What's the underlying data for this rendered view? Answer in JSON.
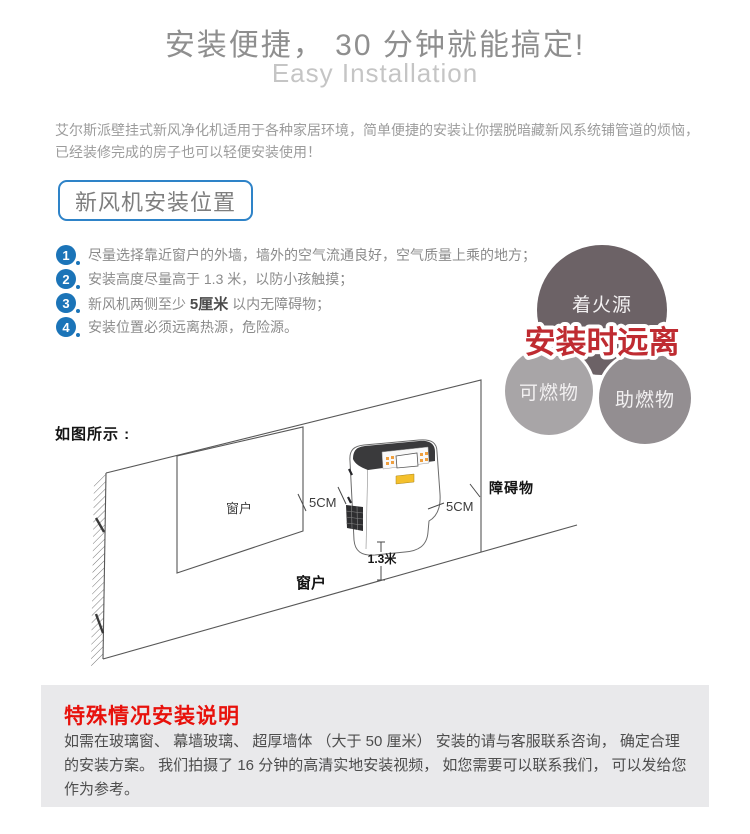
{
  "colors": {
    "blue_step": "#1b74b8",
    "blue_badge_border": "#2e83c8",
    "red_warning": "#bf2b31",
    "red_heading": "#e8120c",
    "title_gray": "#8f8f8f",
    "subtitle_gray": "#c5c5c5",
    "paragraph_gray": "#9c9c9c",
    "list_gray": "#8b8b8b",
    "badge_text_gray": "#7e7e7e",
    "panel_bg": "#e9e9eb",
    "panel_text": "#4d4d4d",
    "bubble_top_bg": "#6c6266",
    "bubble_left_bg": "#a8a5a7",
    "bubble_right_bg": "#938e91",
    "bubble_text": "#f2f0f1",
    "diagram_line": "#575757",
    "label_dark": "#141414",
    "unit_badge_yellow": "#f4c02c"
  },
  "header": {
    "title": "安装便捷， 30 分钟就能搞定!",
    "subtitle": "Easy Installation",
    "intro_line1": "艾尔斯派壁挂式新风净化机适用于各种家居环境，简单便捷的安装让你摆脱暗藏新风系统铺管道的烦恼，",
    "intro_line2": "已经装修完成的房子也可以轻便安装使用！"
  },
  "section": {
    "badge_label": "新风机安装位置"
  },
  "steps": {
    "items": [
      {
        "num": "1",
        "pre": "尽量选择靠近窗户的外墙，墙外的空气流通良好，空气质量上乘的地方；",
        "bold": "",
        "post": ""
      },
      {
        "num": "2",
        "pre": "安装高度尽量高于 1.3 米，以防小孩触摸；",
        "bold": "",
        "post": ""
      },
      {
        "num": "3",
        "pre": "新风机两侧至少 ",
        "bold": "5厘米",
        "post": " 以内无障碍物；"
      },
      {
        "num": "4",
        "pre": "安装位置必须远离热源，危险源。",
        "bold": "",
        "post": ""
      }
    ]
  },
  "hazard": {
    "warning": "安装时远离",
    "top_bubble": "着火源",
    "left_bubble": "可燃物",
    "right_bubble": "助燃物"
  },
  "diagram": {
    "caption": "如图所示 :",
    "window_label": "窗户",
    "bottom_window_label": "窗户",
    "left_gap_label": "5CM",
    "right_gap_label": "5CM",
    "height_label": "1.3米",
    "obstacle_label": "障碍物"
  },
  "note": {
    "heading": "特殊情况安装说明",
    "body": "如需在玻璃窗、 幕墙玻璃、 超厚墙体 （大于 50 厘米） 安装的请与客服联系咨询， 确定合理的安装方案。 我们拍摄了 16 分钟的高清实地安装视频， 如您需要可以联系我们， 可以发给您作为参考。"
  }
}
